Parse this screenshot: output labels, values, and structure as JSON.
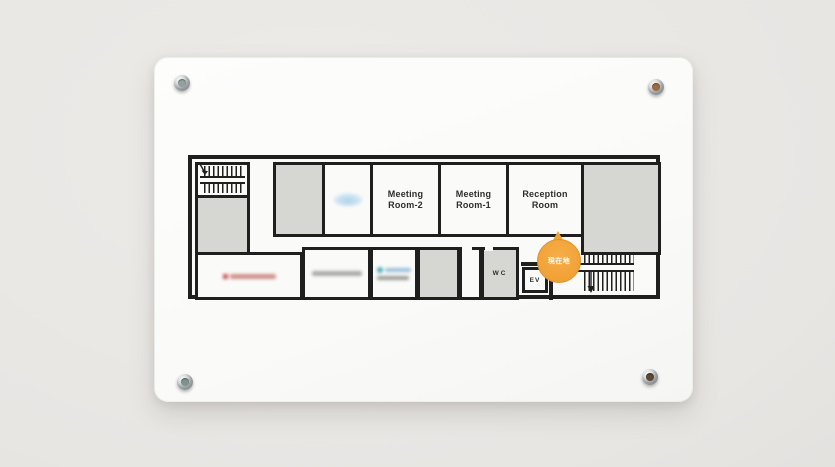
{
  "floor_plan": {
    "rooms": {
      "meeting_room_2": {
        "line1": "Meeting",
        "line2": "Room-2"
      },
      "meeting_room_1": {
        "line1": "Meeting",
        "line2": "Room-1"
      },
      "reception_room": {
        "line1": "Reception",
        "line2": "Room"
      },
      "wc": {
        "label": "WC"
      },
      "elevator": {
        "label": "EV"
      }
    },
    "marker": {
      "label": "現在地",
      "color": "#F2A43C",
      "text_color": "#FFFFFF"
    },
    "tenant_logos": [
      {
        "name": "tenant-logo-blue",
        "color": "#AED3EA",
        "blurred": true
      },
      {
        "name": "tenant-logo-red",
        "color": "#C4392F",
        "blurred": true
      },
      {
        "name": "tenant-logo-gray",
        "color": "#9B9B98",
        "blurred": true
      },
      {
        "name": "tenant-logo-teal",
        "color": "#35A3AE",
        "blurred": true
      }
    ],
    "colors": {
      "wall_line": "#1F1F1F",
      "room_fill_gray": "#D6D6D3",
      "plate_white": "#FBFBFA"
    }
  },
  "hardware": {
    "standoff_count": 4
  }
}
